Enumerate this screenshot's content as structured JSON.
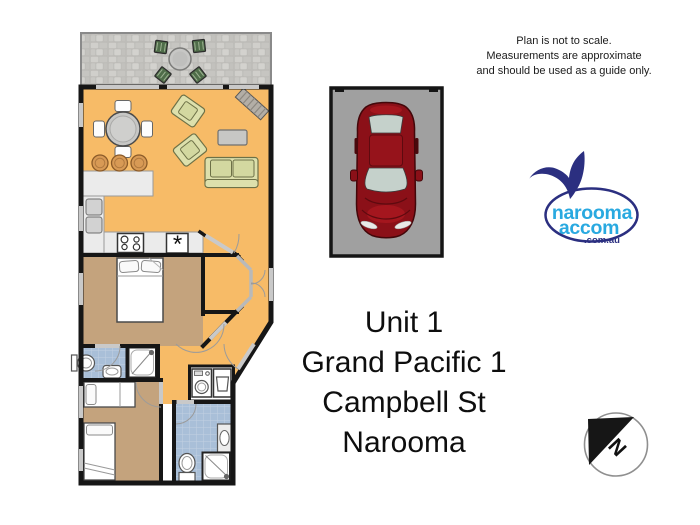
{
  "disclaimer": {
    "lines": [
      "Plan is not to scale.",
      "Measurements are approximate",
      "and should be used as a guide only."
    ]
  },
  "address": {
    "lines": [
      "Unit 1",
      "Grand Pacific 1",
      "Campbell St",
      "Narooma"
    ]
  },
  "logo": {
    "line1": "narooma",
    "line2": "accom",
    "line3": ".com.au"
  },
  "compass": {
    "label": "N"
  },
  "floor_plan": {
    "kitchen_symbol": "*",
    "rooms": [
      {
        "name": "deck",
        "floor": "stone-gray"
      },
      {
        "name": "living-dining-kitchen",
        "floor": "orange"
      },
      {
        "name": "bedroom-1",
        "floor": "tan"
      },
      {
        "name": "ensuite-bathroom",
        "floor": "blue-tile"
      },
      {
        "name": "bedroom-2",
        "floor": "tan"
      },
      {
        "name": "bathroom-laundry",
        "floor": "blue-tile"
      },
      {
        "name": "entry-hall",
        "floor": "orange"
      }
    ],
    "furniture": [
      "outdoor-table-setting",
      "dining-table-4-chairs",
      "breakfast-bar-3-stools",
      "armchair",
      "armchair",
      "coffee-table",
      "sofa",
      "hall-bench",
      "fridge",
      "stove",
      "double-bed",
      "single-bed",
      "single-bed",
      "toilet",
      "toilet",
      "basin",
      "vanity",
      "shower",
      "shower",
      "washing-machine",
      "laundry-tub"
    ]
  },
  "car_space": {
    "vehicle": "red-car-top-view"
  },
  "colors": {
    "floor_orange": "#f7bb67",
    "floor_tan": "#c4a37d",
    "tile_blue": "#a9bfd8",
    "counter_gray": "#ebebeb",
    "wall_black": "#161616",
    "furn_green": "#dde0ac",
    "furn_green_light": "#d3d8a0",
    "stool_orange": "#d89a55",
    "logo_navy": "#2b2f80",
    "logo_blue": "#29a9e0",
    "car_red": "#8b1018",
    "glass_gray": "#c5d1cb",
    "space_gray": "#a0a0a0",
    "window_gray": "#c9c9c9"
  }
}
